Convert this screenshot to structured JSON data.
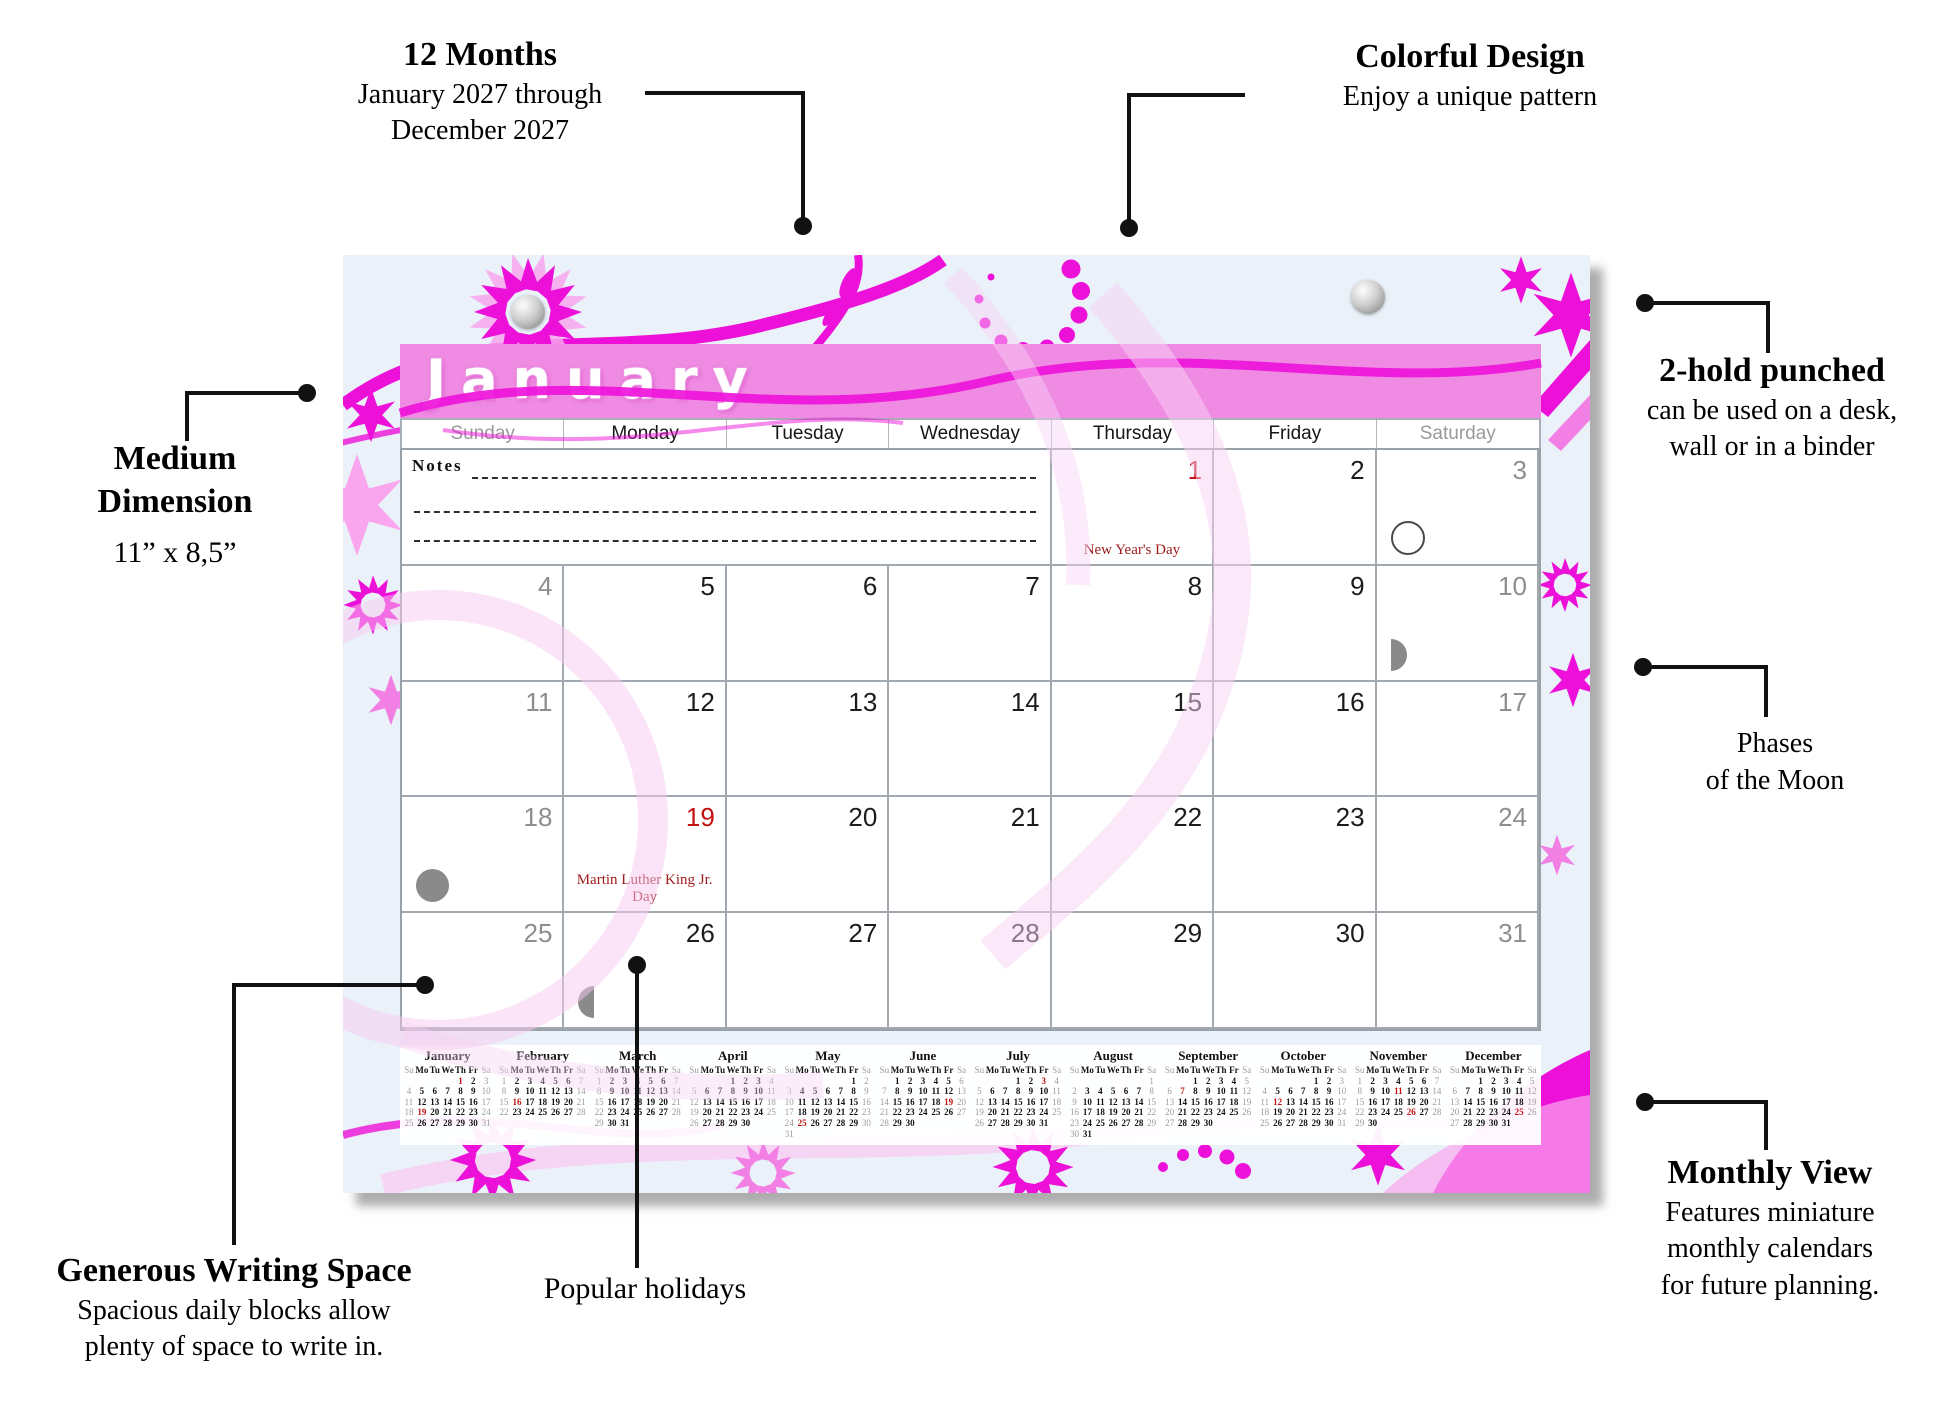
{
  "callouts": {
    "months": {
      "title": "12 Months",
      "line1": "January 2027 through",
      "line2": "December 2027"
    },
    "design": {
      "title": "Colorful Design",
      "line1": "Enjoy a unique pattern"
    },
    "punched": {
      "title": "2-hold punched",
      "line1": "can be used on a desk,",
      "line2": "wall or in a binder"
    },
    "moon": {
      "line1": "Phases",
      "line2": "of the Moon"
    },
    "monthly": {
      "title": "Monthly View",
      "line1": "Features miniature",
      "line2": "monthly calendars",
      "line3": "for future planning."
    },
    "dimension": {
      "title1": "Medium",
      "title2": "Dimension",
      "line1": "11” x 8,5”"
    },
    "writing": {
      "title": "Generous Writing Space",
      "line1": "Spacious daily blocks allow",
      "line2": "plenty of space to write in."
    },
    "holidays": {
      "title": "Popular holidays"
    }
  },
  "main": {
    "title": "January",
    "weekdays": [
      "Sunday",
      "Monday",
      "Tuesday",
      "Wednesday",
      "Thursday",
      "Friday",
      "Saturday"
    ],
    "notes_label": "Notes",
    "start": 4,
    "days": 31,
    "red": [
      1,
      19
    ],
    "holidays": {
      "1": "New Year's Day",
      "19": "Martin Luther King Jr. Day"
    },
    "moons": {
      "3": "full",
      "10": "third",
      "18": "new",
      "26": "first"
    }
  },
  "mini_day_header": [
    "Su",
    "Mo",
    "Tu",
    "We",
    "Th",
    "Fr",
    "Sa"
  ],
  "mini_months": [
    {
      "name": "January",
      "start": 4,
      "days": 31,
      "red": [
        1,
        19
      ]
    },
    {
      "name": "February",
      "start": 0,
      "days": 28,
      "red": [
        16
      ]
    },
    {
      "name": "March",
      "start": 0,
      "days": 31,
      "red": []
    },
    {
      "name": "April",
      "start": 3,
      "days": 30,
      "red": []
    },
    {
      "name": "May",
      "start": 5,
      "days": 31,
      "red": [
        25
      ]
    },
    {
      "name": "June",
      "start": 1,
      "days": 30,
      "red": [
        19
      ]
    },
    {
      "name": "July",
      "start": 3,
      "days": 31,
      "red": [
        3
      ]
    },
    {
      "name": "August",
      "start": 6,
      "days": 31,
      "red": []
    },
    {
      "name": "September",
      "start": 2,
      "days": 30,
      "red": [
        7
      ]
    },
    {
      "name": "October",
      "start": 4,
      "days": 31,
      "red": [
        12
      ]
    },
    {
      "name": "November",
      "start": 0,
      "days": 30,
      "red": [
        11,
        26
      ]
    },
    {
      "name": "December",
      "start": 2,
      "days": 31,
      "red": [
        25
      ]
    }
  ],
  "colors": {
    "magenta": "#ED10D8",
    "light_pink": "#F9A6EF",
    "band_pink": "#EF8BE3",
    "holiday_red": "#C41212",
    "holiday_text_red": "#9E1B1B",
    "gray_day": "#8E8E8E",
    "pad_background": "#EAF1F9"
  }
}
